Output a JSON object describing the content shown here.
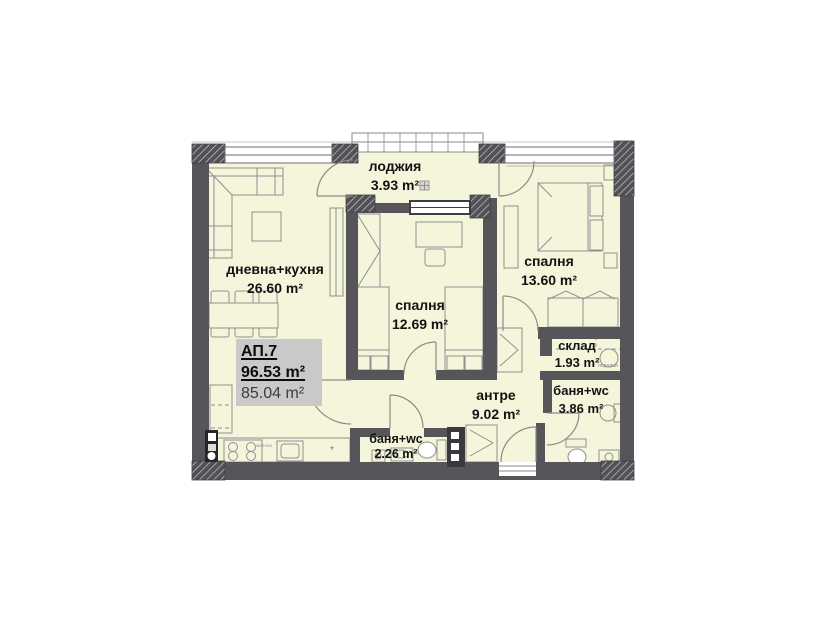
{
  "plan": {
    "apartment": {
      "id": "АП.7",
      "total_area": "96.53 m²",
      "net_area": "85.04 m²"
    },
    "rooms": [
      {
        "id": "loggia",
        "name": "лоджия",
        "area": "3.93 m²"
      },
      {
        "id": "living-kitchen",
        "name": "дневна+кухня",
        "area": "26.60 m²"
      },
      {
        "id": "bedroom-1",
        "name": "спалня",
        "area": "12.69 m²"
      },
      {
        "id": "bedroom-2",
        "name": "спалня",
        "area": "13.60 m²"
      },
      {
        "id": "storage",
        "name": "склад",
        "area": "1.93 m²"
      },
      {
        "id": "bathroom-big",
        "name": "баня+wc",
        "area": "3.86 m²"
      },
      {
        "id": "hallway",
        "name": "антре",
        "area": "9.02 m²"
      },
      {
        "id": "bathroom-small",
        "name": "баня+wc",
        "area": "2.26 m²"
      }
    ],
    "annotations": {
      "washing_machine": "пералня",
      "kitchen_unit": "миялна",
      "kitchen_mark": "*"
    },
    "colors": {
      "floor": "#f5f5dc",
      "wall": "#55555a",
      "highlight_box": "#c9c9c9",
      "furniture_line": "#8f8f8f",
      "text": "#121212"
    }
  }
}
